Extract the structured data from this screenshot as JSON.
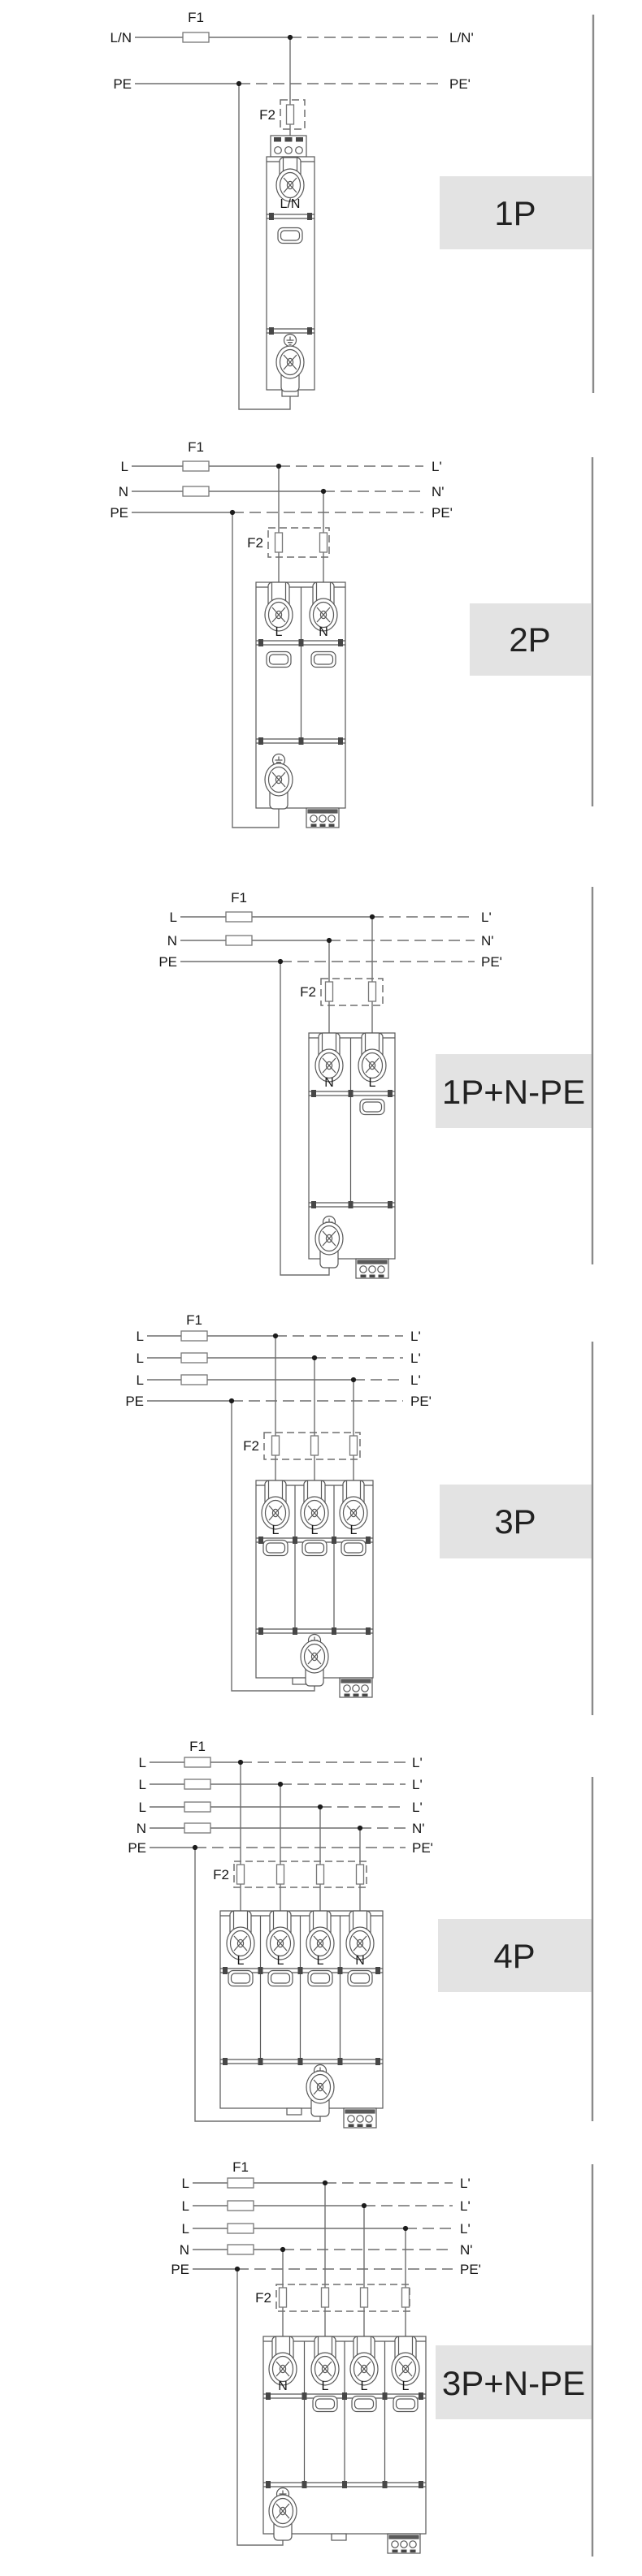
{
  "colors": {
    "badge_bg": "#e3e3e3",
    "wire": "#6e6e6e",
    "device_stroke": "#585858",
    "text": "#161616",
    "rule": "#8a8a8a"
  },
  "sections": [
    {
      "badge": "1P",
      "f1": "F1",
      "f2": "F2",
      "lines": [
        {
          "left": "L/N",
          "right": "L/N'"
        },
        {
          "left": "PE",
          "right": "PE'"
        }
      ],
      "terminals": [
        "L/N"
      ]
    },
    {
      "badge": "2P",
      "f1": "F1",
      "f2": "F2",
      "lines": [
        {
          "left": "L",
          "right": "L'"
        },
        {
          "left": "N",
          "right": "N'"
        },
        {
          "left": "PE",
          "right": "PE'"
        }
      ],
      "terminals": [
        "L",
        "N"
      ]
    },
    {
      "badge": "1P+N-PE",
      "f1": "F1",
      "f2": "F2",
      "lines": [
        {
          "left": "L",
          "right": "L'"
        },
        {
          "left": "N",
          "right": "N'"
        },
        {
          "left": "PE",
          "right": "PE'"
        }
      ],
      "terminals": [
        "N",
        "L"
      ]
    },
    {
      "badge": "3P",
      "f1": "F1",
      "f2": "F2",
      "lines": [
        {
          "left": "L",
          "right": "L'"
        },
        {
          "left": "L",
          "right": "L'"
        },
        {
          "left": "L",
          "right": "L'"
        },
        {
          "left": "PE",
          "right": "PE'"
        }
      ],
      "terminals": [
        "L",
        "L",
        "L"
      ]
    },
    {
      "badge": "4P",
      "f1": "F1",
      "f2": "F2",
      "lines": [
        {
          "left": "L",
          "right": "L'"
        },
        {
          "left": "L",
          "right": "L'"
        },
        {
          "left": "L",
          "right": "L'"
        },
        {
          "left": "N",
          "right": "N'"
        },
        {
          "left": "PE",
          "right": "PE'"
        }
      ],
      "terminals": [
        "L",
        "L",
        "L",
        "N"
      ]
    },
    {
      "badge": "3P+N-PE",
      "f1": "F1",
      "f2": "F2",
      "lines": [
        {
          "left": "L",
          "right": "L'"
        },
        {
          "left": "L",
          "right": "L'"
        },
        {
          "left": "L",
          "right": "L'"
        },
        {
          "left": "N",
          "right": "N'"
        },
        {
          "left": "PE",
          "right": "PE'"
        }
      ],
      "terminals": [
        "N",
        "L",
        "L",
        "L"
      ]
    }
  ]
}
